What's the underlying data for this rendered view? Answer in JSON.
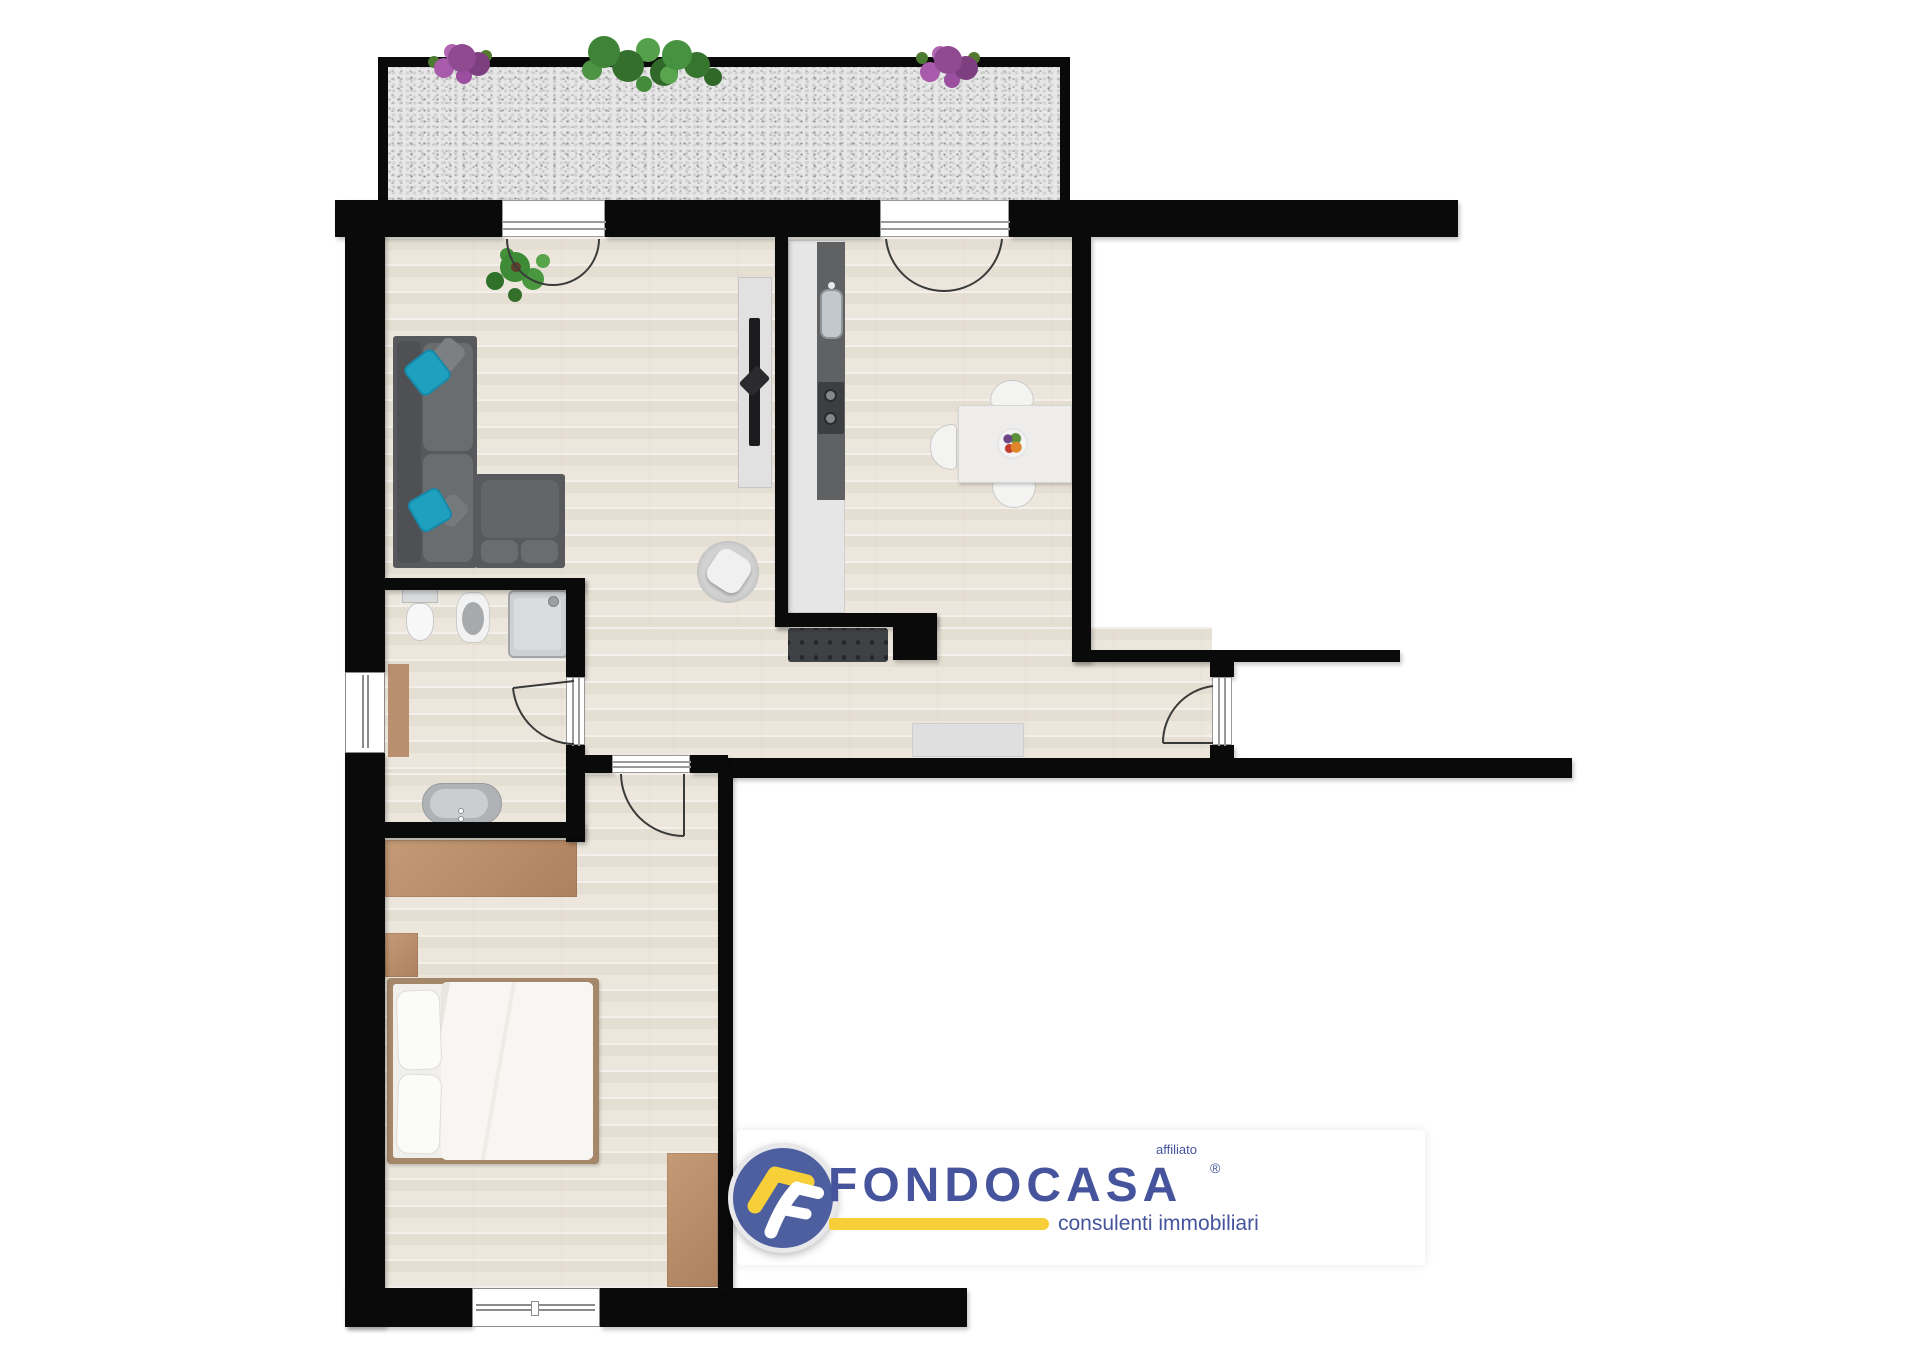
{
  "document": {
    "type": "real-estate-floor-plan",
    "width_px": 1920,
    "height_px": 1358,
    "background": "#ffffff"
  },
  "branding": {
    "affiliate_label": "affiliato",
    "brand_name": "FONDOCASA",
    "registered_symbol": "®",
    "tagline": "consulenti immobiliari",
    "colors": {
      "brand_text_blue": "#45549c",
      "logo_circle_blue": "#4e5f9f",
      "accent_yellow": "#f6cf39",
      "band_white": "#ffffff"
    }
  },
  "plan": {
    "colors": {
      "wall_black": "#0a0a0a",
      "wood_floor": "#e9e4da",
      "terrace_gravel": "#e7e7e7",
      "sofa_gray": "#57595c",
      "cushion_teal": "#1fa0bf",
      "furniture_brown": "#b88c68",
      "fixture_light_gray": "#c9ccce",
      "counter_dark_gray": "#5f6163"
    },
    "rooms": [
      {
        "name": "terrace",
        "features": [
          "gravel-paving",
          "purple-flower-bush",
          "green-shrubs",
          "purple-flower-bush"
        ]
      },
      {
        "name": "living-room",
        "features": [
          "l-shaped-sofa",
          "two-teal-cushions",
          "tv-sideboard",
          "potted-plant",
          "french-door-to-terrace"
        ]
      },
      {
        "name": "kitchen",
        "features": [
          "counter-with-sink",
          "two-burner-cooktop",
          "partition-wall",
          "radiator-bench",
          "round-pouf"
        ]
      },
      {
        "name": "dining-area",
        "features": [
          "square-table",
          "three-chairs",
          "fruit-bowl",
          "french-door-to-terrace"
        ]
      },
      {
        "name": "hallway",
        "features": [
          "entrance-door",
          "doormat"
        ]
      },
      {
        "name": "bathroom",
        "features": [
          "toilet",
          "bidet",
          "shower-cabin",
          "washbasin",
          "storage-cabinet",
          "window",
          "door"
        ]
      },
      {
        "name": "bedroom",
        "features": [
          "double-bed",
          "wardrobe",
          "nightstand",
          "dresser",
          "window",
          "door"
        ]
      }
    ]
  }
}
